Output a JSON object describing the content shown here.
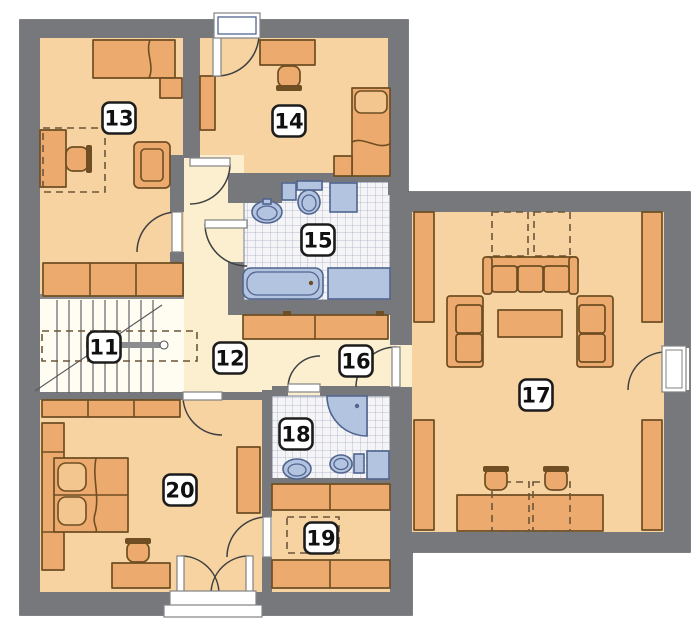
{
  "plan": {
    "rooms": [
      {
        "number": "11"
      },
      {
        "number": "12"
      },
      {
        "number": "13"
      },
      {
        "number": "14"
      },
      {
        "number": "15"
      },
      {
        "number": "16"
      },
      {
        "number": "17"
      },
      {
        "number": "18"
      },
      {
        "number": "19"
      },
      {
        "number": "20"
      }
    ]
  },
  "colors": {
    "background": "#ffffff",
    "wall": "#77787c",
    "wall_light": "#8b8c90",
    "room_floor": "#f7d3a2",
    "hall_floor": "#fbefcf",
    "stairs_floor": "#fffdf2",
    "furniture": "#ecaa6e",
    "furniture_light": "#f3c690",
    "furniture_outline": "#6e4e22",
    "tile_bg": "#f5f5f7",
    "tile_line": "#a6aec2",
    "tile_border": "#8892a8",
    "fixture": "#b3c4e1",
    "fixture_outline": "#50648e",
    "label_bg": "#ffffff",
    "label_border": "#1c1c1c",
    "label_text": "#101010",
    "door_line": "#3f4042",
    "window_fill": "#ffffff",
    "window_border": "#828282",
    "dash_line": "#6b5539",
    "perimeter": "#55565c"
  }
}
